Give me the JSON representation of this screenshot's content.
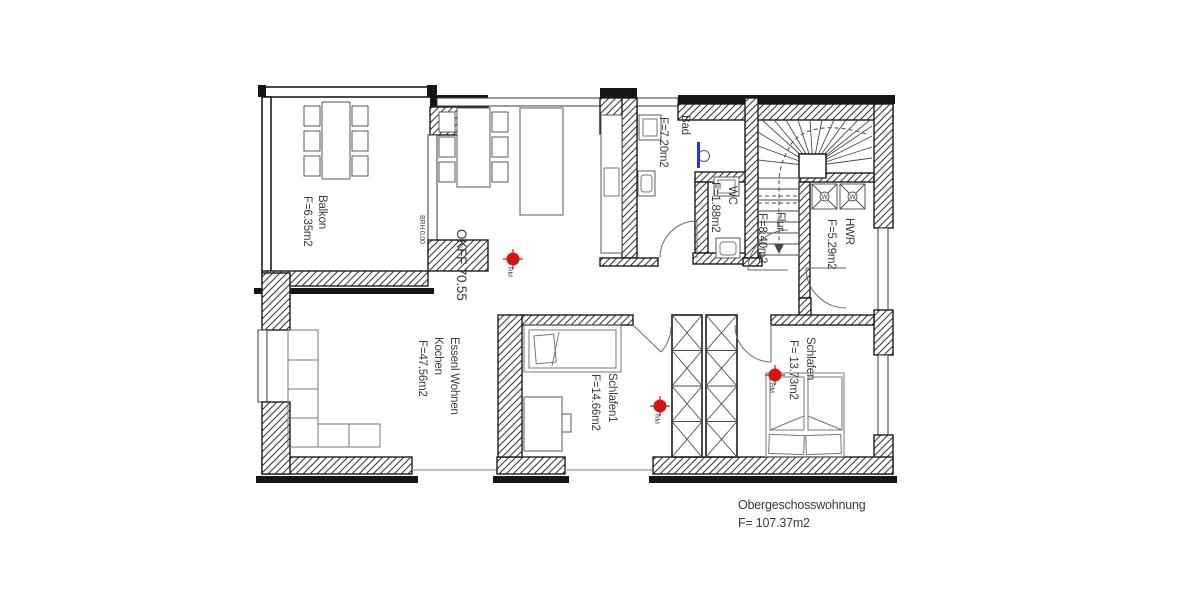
{
  "plan": {
    "caption": {
      "title": "Obergeschosswohnung",
      "area": "F=  107.37m2"
    },
    "level_label": "OKFF  70.55",
    "sill_label": "BRH 0.00",
    "rooms": [
      {
        "name": "Balkon",
        "area": "F=6.35m2"
      },
      {
        "name": "Essenl Wohnen",
        "name2": "Kochen",
        "area": "F=47.56m2"
      },
      {
        "name": "Bad",
        "area": "F=7.20m2"
      },
      {
        "name": "WC",
        "area": "F=1.88m2"
      },
      {
        "name": "Flur",
        "area": "F=8.40m2"
      },
      {
        "name": "HWR",
        "area": "F=5.29m2"
      },
      {
        "name": "Schlafen1",
        "area": "F=14.66m2"
      },
      {
        "name": "Schlafen",
        "area": "F= 13.73m2"
      }
    ],
    "smoke_detector_label": "RM",
    "washer_label": "W",
    "colors": {
      "level_text": "#b04038",
      "detector": "#d01717",
      "shower_screen": "#2b35c8",
      "wall": "#1c1c1c"
    }
  }
}
